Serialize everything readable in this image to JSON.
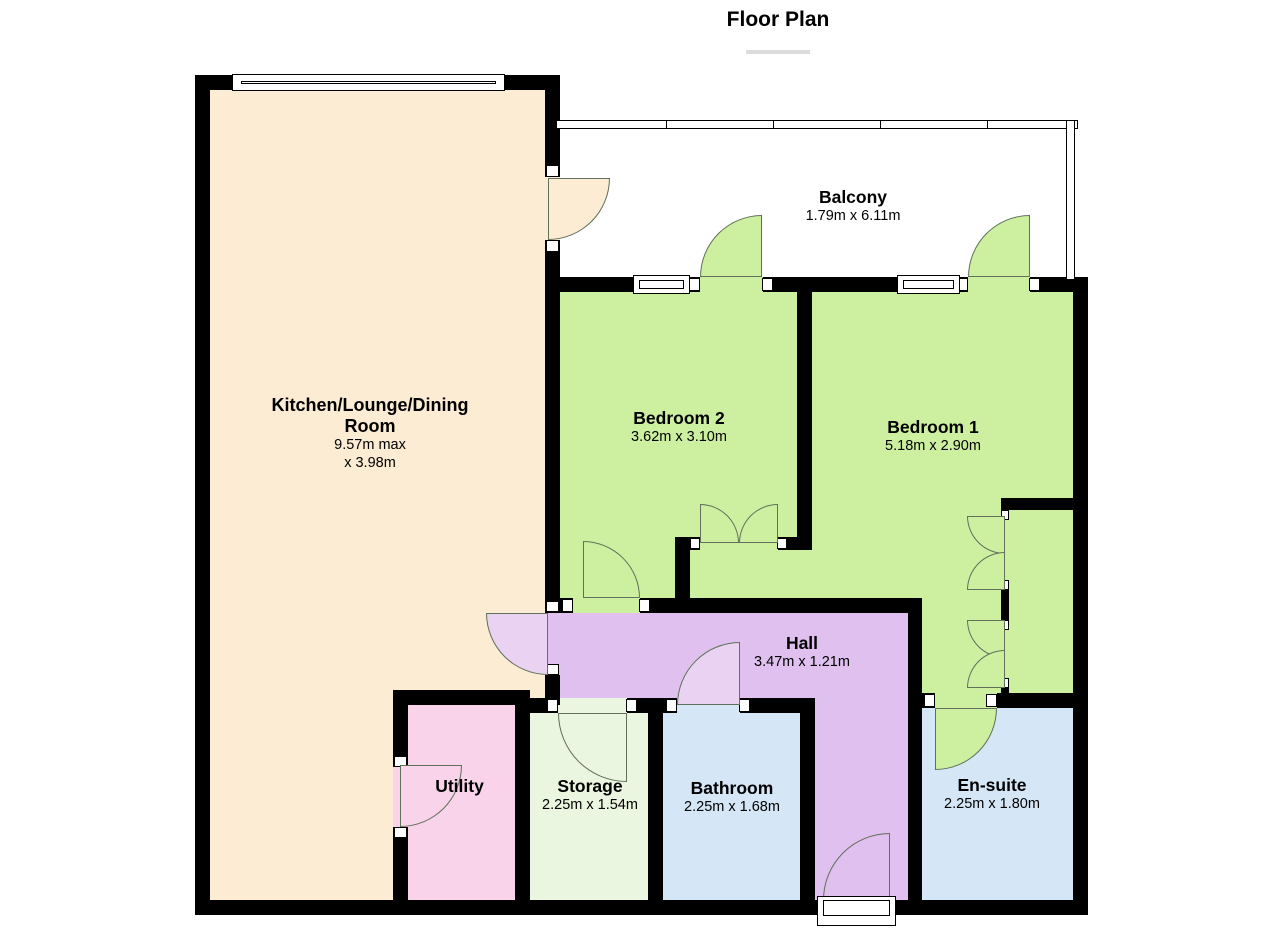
{
  "title": "Floor Plan",
  "rooms": {
    "kitchen": {
      "name_line1": "Kitchen/Lounge/Dining",
      "name_line2": "Room",
      "dims_line1": "9.57m max",
      "dims_line2": "x 3.98m"
    },
    "balcony": {
      "name": "Balcony",
      "dims": "1.79m x 6.11m"
    },
    "bedroom2": {
      "name": "Bedroom 2",
      "dims": "3.62m x 3.10m"
    },
    "bedroom1": {
      "name": "Bedroom 1",
      "dims": "5.18m x 2.90m"
    },
    "hall": {
      "name": "Hall",
      "dims": "3.47m x 1.21m"
    },
    "utility": {
      "name": "Utility"
    },
    "storage": {
      "name": "Storage",
      "dims": "2.25m x 1.54m"
    },
    "bathroom": {
      "name": "Bathroom",
      "dims": "2.25m x 1.68m"
    },
    "ensuite": {
      "name": "En-suite",
      "dims": "2.25m x 1.80m"
    }
  },
  "colors": {
    "kitchen": "#fbecd3",
    "bedroom": "#cdf0a0",
    "hall": "#dfc0ee",
    "hall_door": "#ead2f3",
    "utility": "#f9d3e9",
    "storage": "#eaf6df",
    "bathroom": "#d5e7f7",
    "balcony": "#ffffff",
    "wall": "#000000",
    "door_arc": "#60705a"
  }
}
